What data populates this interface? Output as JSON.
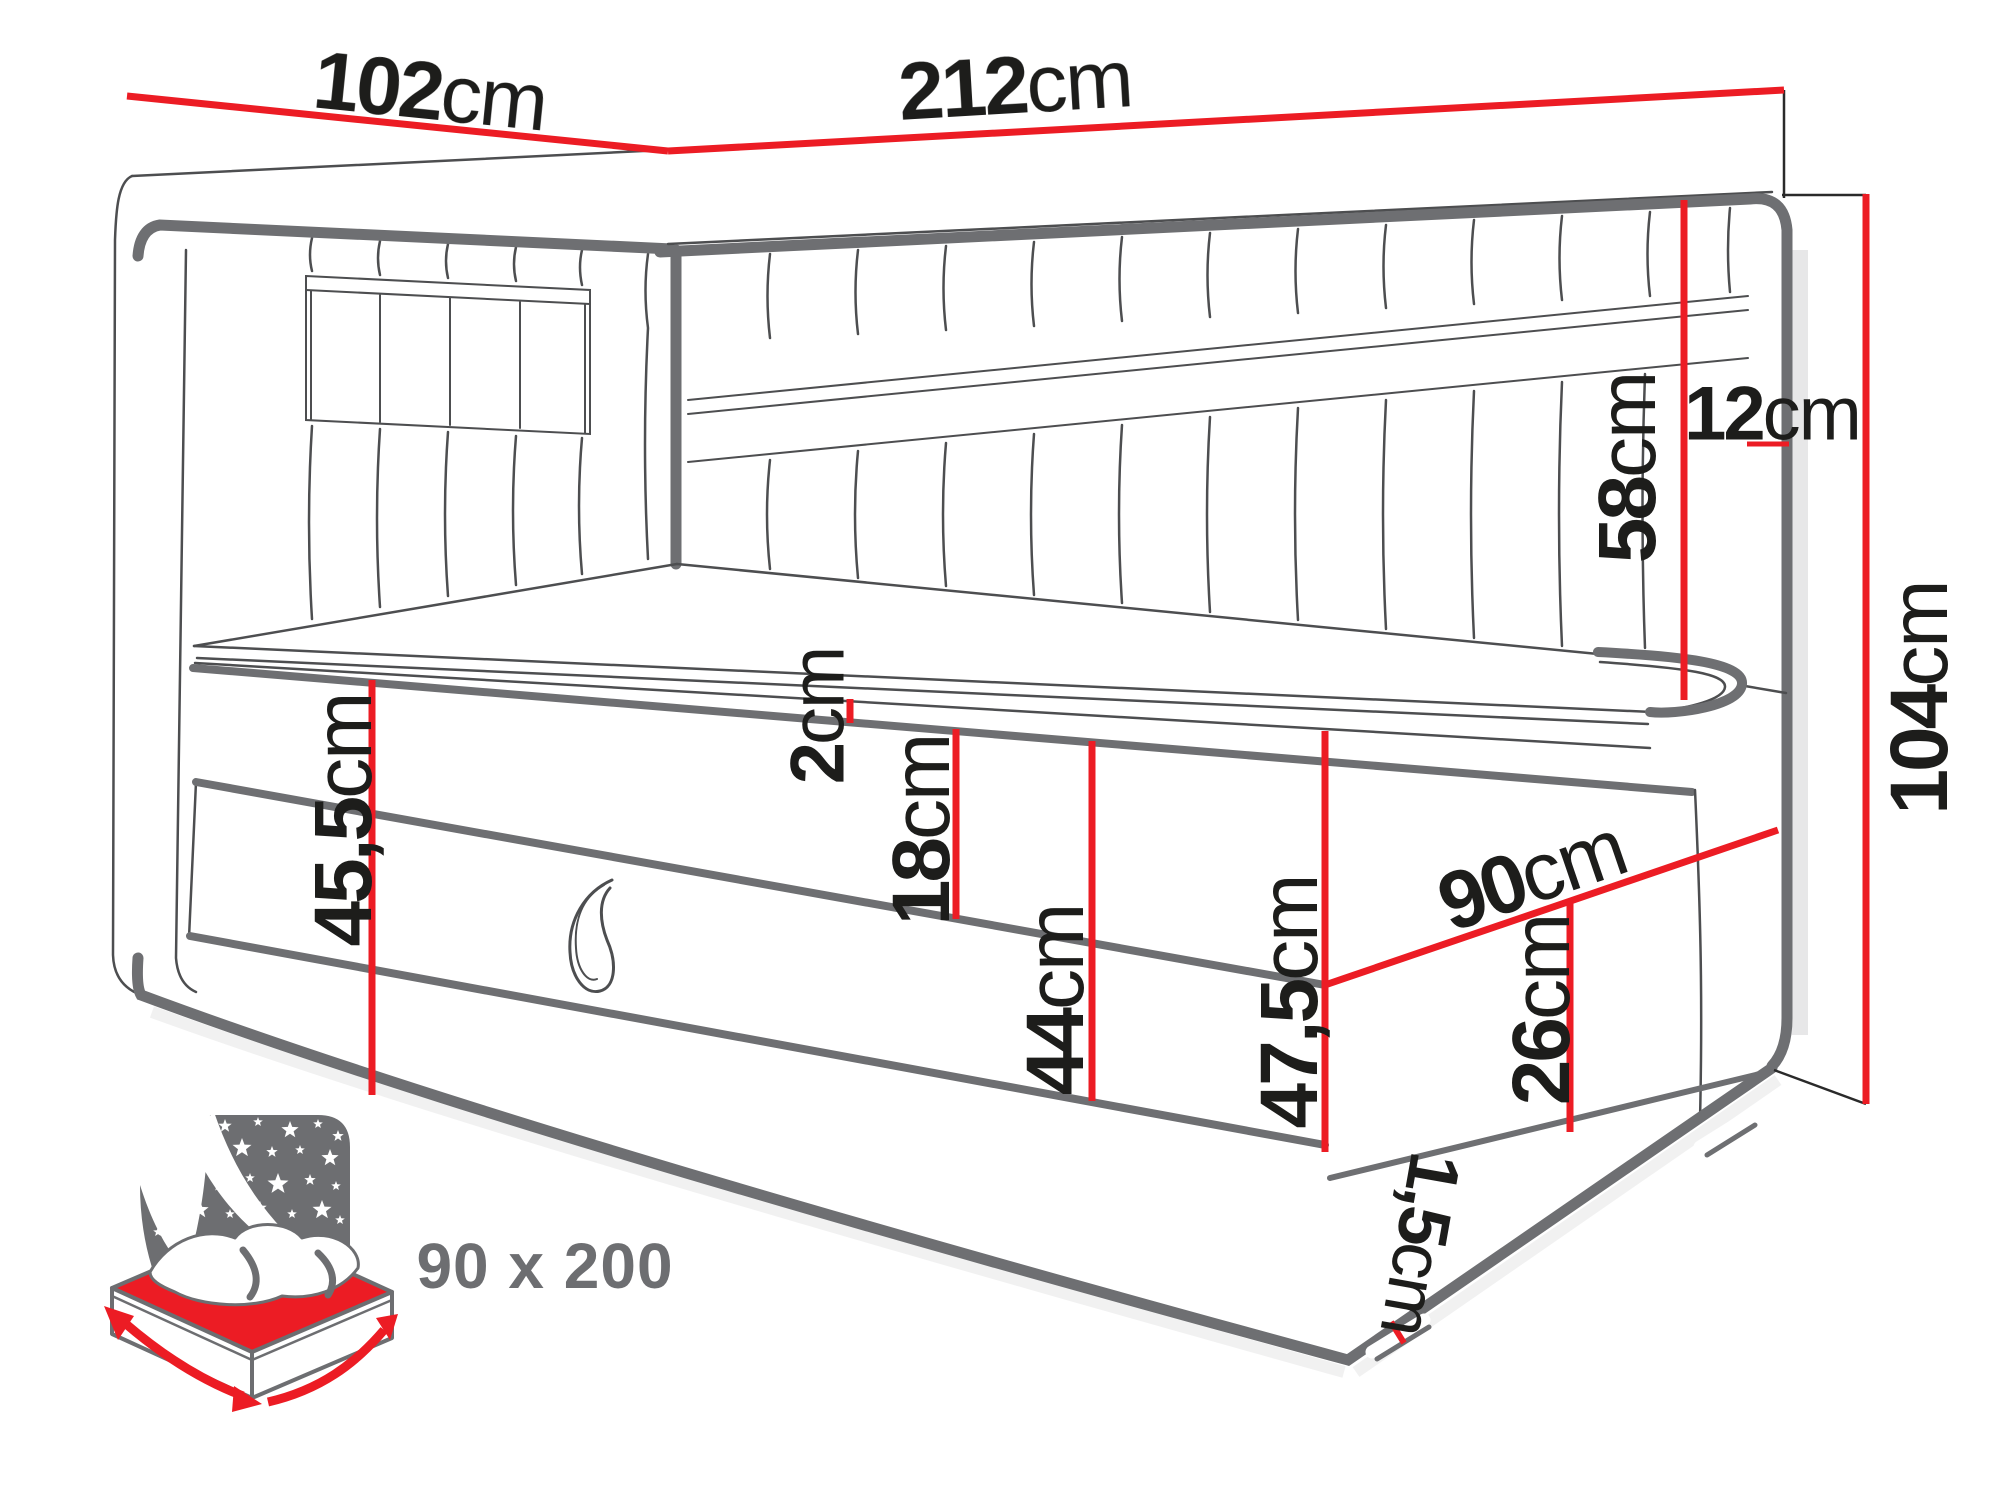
{
  "diagram": {
    "kind": "furniture dimension diagram",
    "subject": "corner daybed with storage drawer",
    "accent_color": "#ec1c24",
    "outline_thick_color": "#6e6f72",
    "outline_thin_color": "#4d4e50",
    "icon_gray": "#6d6e71",
    "text_color": "#1d1d1b"
  },
  "dims": {
    "left_headboard_width": {
      "value": "102",
      "unit": "cm"
    },
    "right_headboard_length": {
      "value": "212",
      "unit": "cm"
    },
    "headboard_thickness": {
      "value": "12",
      "unit": "cm"
    },
    "headboard_above_mattress": {
      "value": "58",
      "unit": "cm"
    },
    "total_height": {
      "value": "104",
      "unit": "cm"
    },
    "side_height": {
      "value": "45,5",
      "unit": "cm"
    },
    "topper_height": {
      "value": "2",
      "unit": "cm"
    },
    "mattress_height": {
      "value": "18",
      "unit": "cm"
    },
    "base_height": {
      "value": "44",
      "unit": "cm"
    },
    "front_total_height": {
      "value": "47,5",
      "unit": "cm"
    },
    "bed_width": {
      "value": "90",
      "unit": "cm"
    },
    "drawer_height": {
      "value": "26",
      "unit": "cm"
    },
    "plinth_height": {
      "value": "1,5",
      "unit": "cm"
    }
  },
  "badge": {
    "sleeping_area": "90 x 200"
  }
}
